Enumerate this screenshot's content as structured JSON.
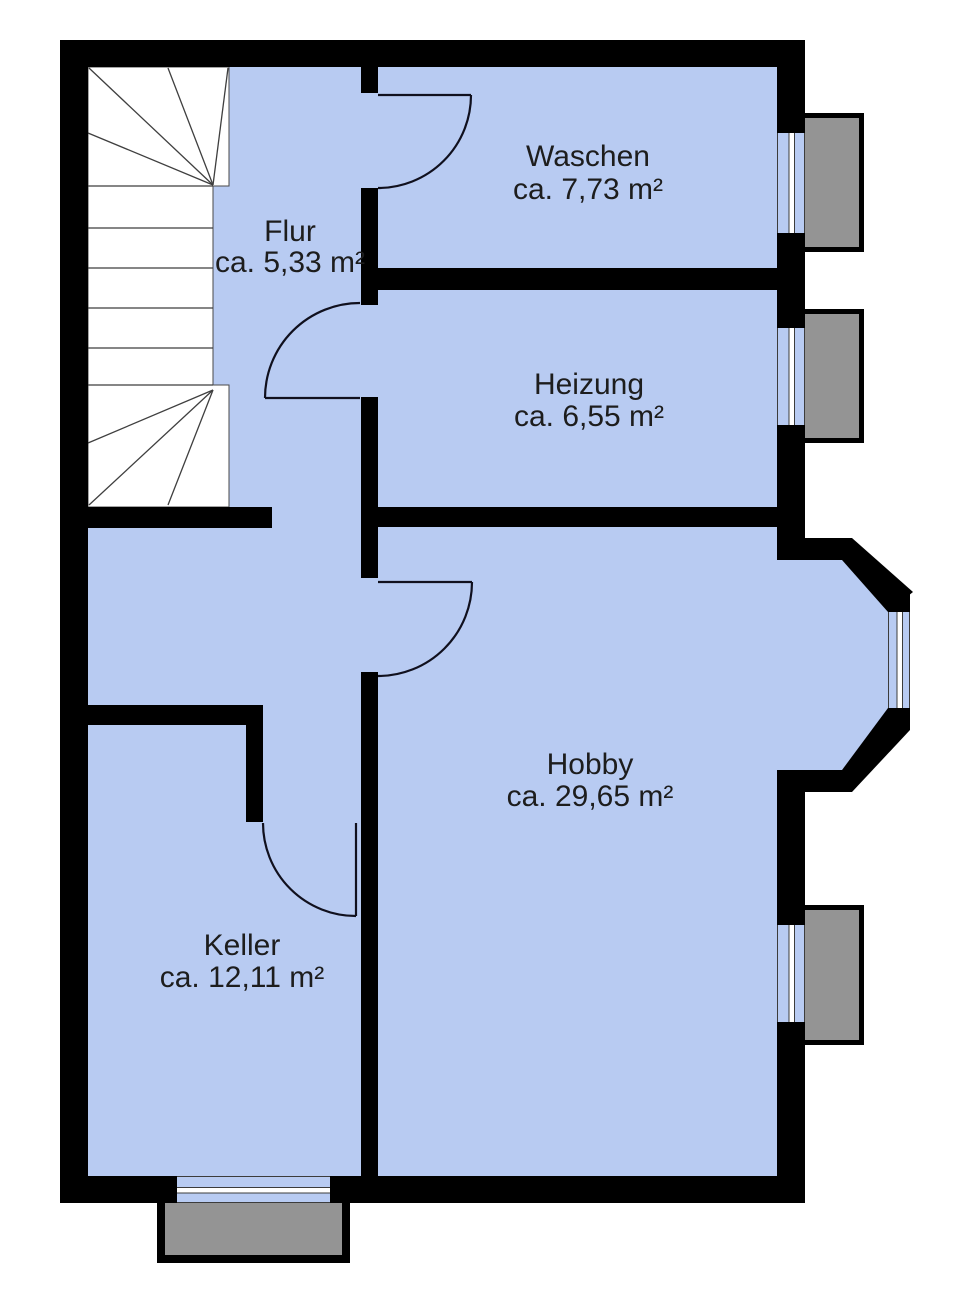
{
  "rooms": [
    {
      "id": "waschen",
      "name": "Waschen",
      "area": "ca. 7,73 m²"
    },
    {
      "id": "flur",
      "name": "Flur",
      "area": "ca. 5,33 m²"
    },
    {
      "id": "heizung",
      "name": "Heizung",
      "area": "ca. 6,55 m²"
    },
    {
      "id": "hobby",
      "name": "Hobby",
      "area": "ca. 29,65 m²"
    },
    {
      "id": "keller",
      "name": "Keller",
      "area": "ca. 12,11 m²"
    }
  ],
  "colors": {
    "room_fill": "#b8cbf2",
    "wall": "#000000",
    "light_well": "#949494",
    "stair_fill": "#ffffff",
    "text": "#1d1d1d",
    "background": "#ffffff"
  }
}
